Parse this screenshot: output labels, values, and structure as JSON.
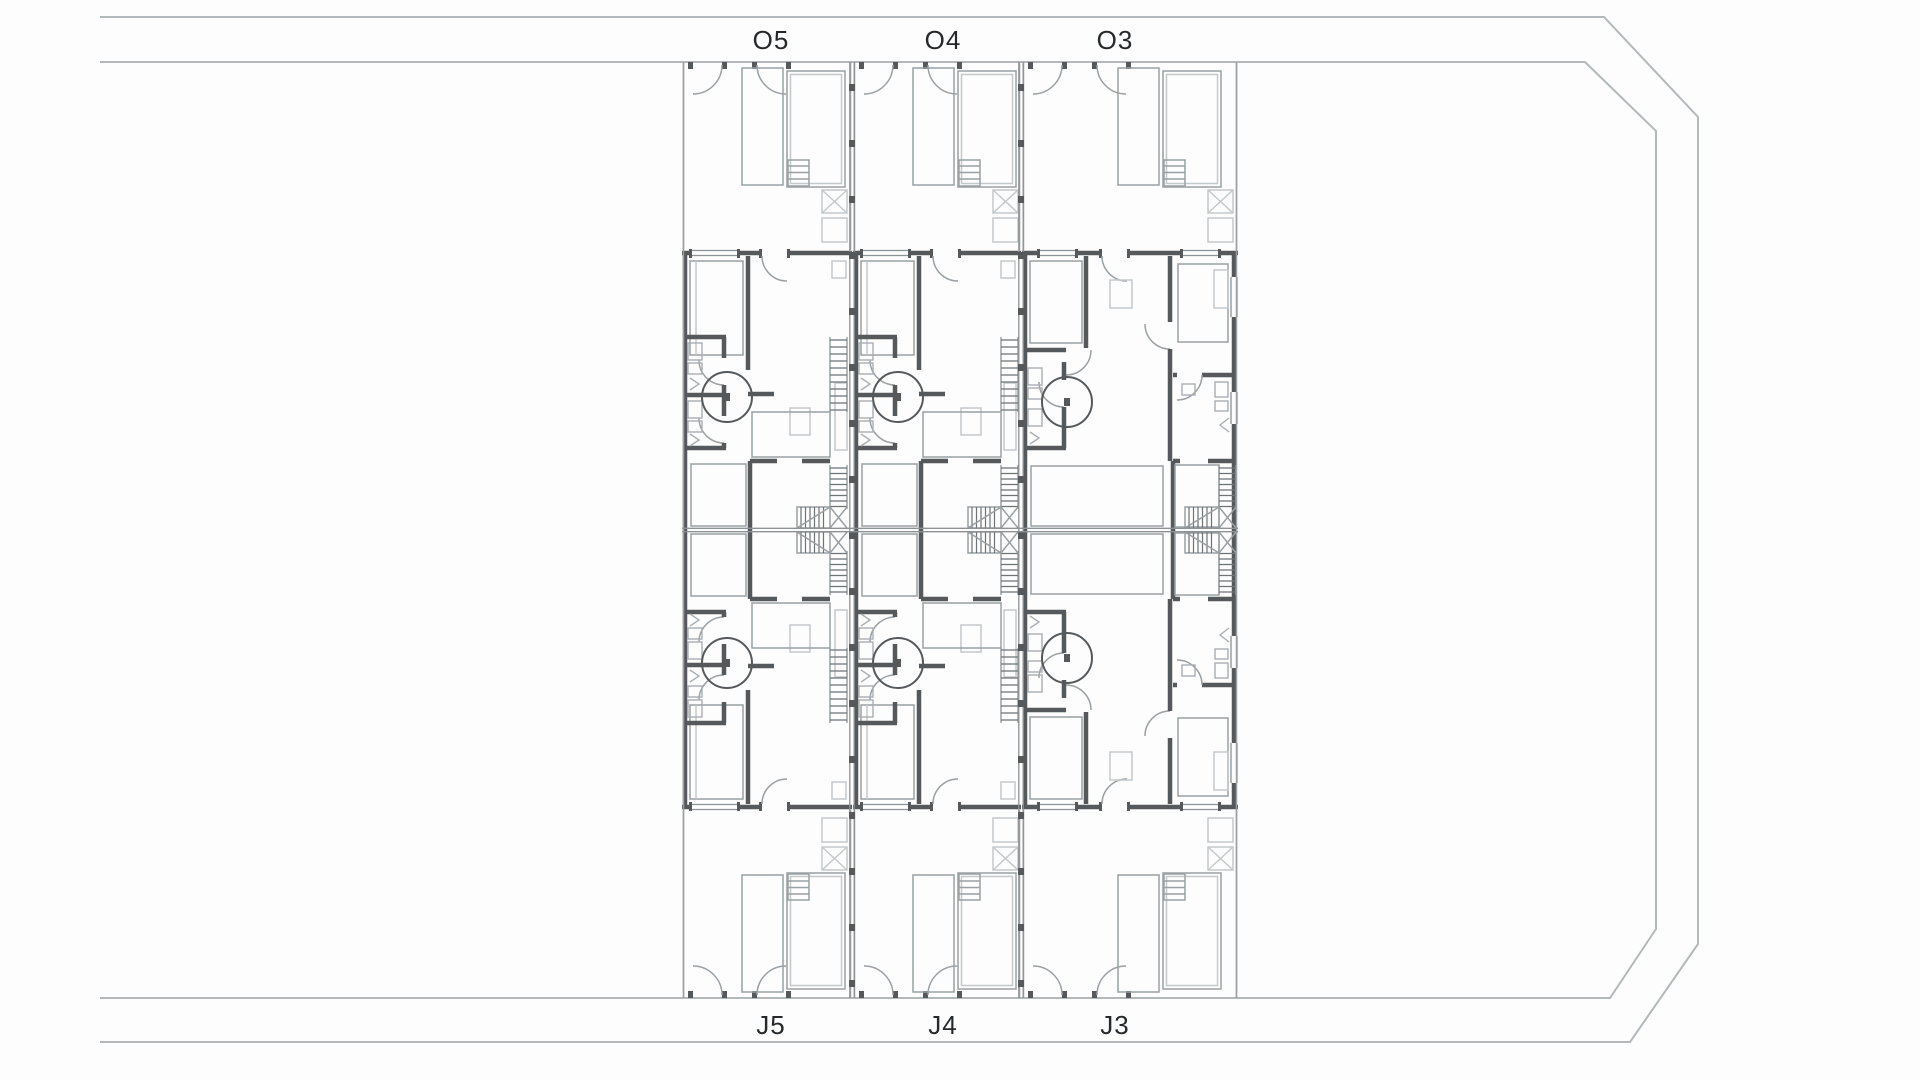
{
  "page": {
    "background": "#fdfdfd",
    "width": 1920,
    "height": 1080
  },
  "plan": {
    "colors": {
      "boundary": "#b3b8ba",
      "thin_line": "#9aa0a4",
      "wall": "#55595c",
      "light_detail": "#c4c9cc",
      "fixture": "#a9afb3",
      "stair_hatch": "#6e7376",
      "label_text": "#26292c",
      "background": "#fdfdfd"
    },
    "boundary": {
      "outer_points": "100,17 1604,17 1698,117 1698,944 1630,1042 100,1042",
      "inner_points": "100,62 1585,62 1656,131 1656,929 1610,998 100,998"
    },
    "block": {
      "left": 682,
      "right": 1238,
      "top": 62,
      "bottom": 998,
      "mirror_y": 530,
      "party_walls": [
        852,
        1021
      ]
    },
    "columns": [
      {
        "x": 682,
        "width": 170,
        "type": "standard",
        "top_label": "O5",
        "bottom_label": "J5",
        "label_x": 771
      },
      {
        "x": 853,
        "width": 168,
        "type": "standard",
        "top_label": "O4",
        "bottom_label": "J4",
        "label_x": 943
      },
      {
        "x": 1022,
        "width": 216,
        "type": "end",
        "top_label": "O3",
        "bottom_label": "J3",
        "label_x": 1115
      }
    ],
    "top_label_y": 49,
    "bottom_label_y": 1034
  }
}
